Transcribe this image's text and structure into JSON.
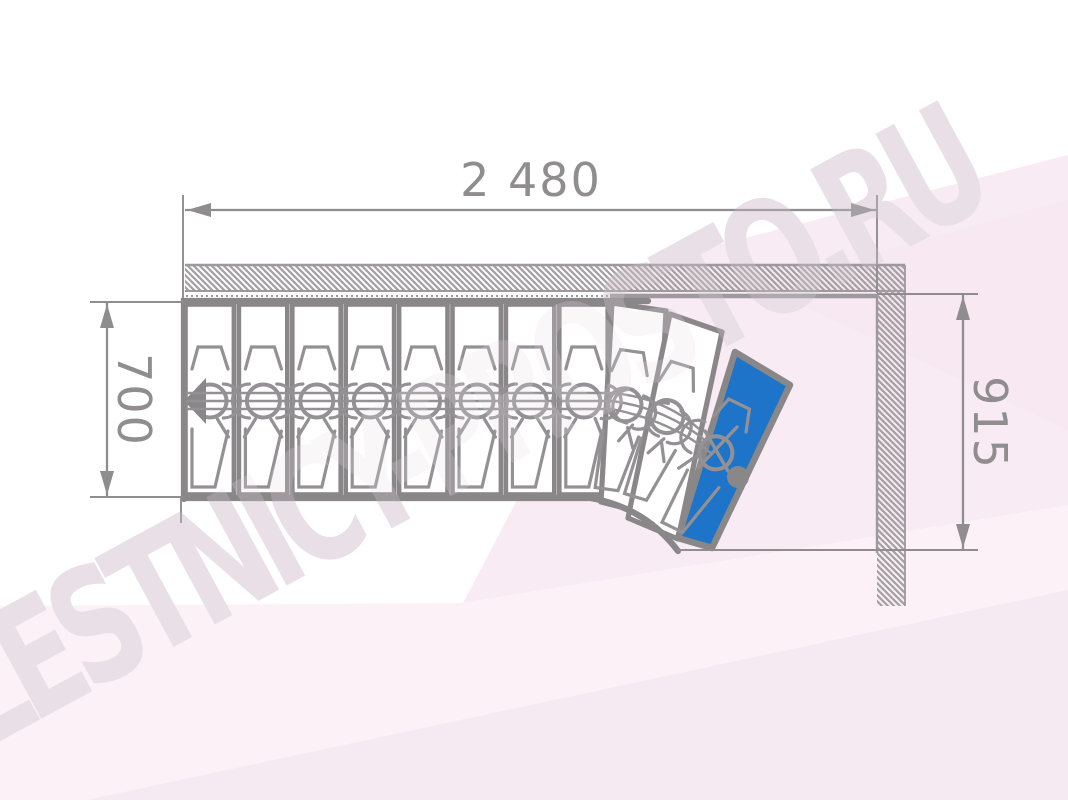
{
  "drawing": {
    "type": "staircase-floor-plan",
    "watermark_text": "LESTNICY-PROSTO.RU",
    "dimensions": {
      "total_run_label": "2 480",
      "stair_width_label": "700",
      "exit_offset_label": "915"
    },
    "steps": {
      "total": 11,
      "straight": 8,
      "winders": 3,
      "highlighted": "last step (turned, blue)"
    }
  },
  "colors": {
    "line": "#8a8789",
    "inner": "#949194",
    "dim": "#908d8f",
    "hatch": "#a5a1a4",
    "blue": "#1e74c8",
    "wm": "#e9dfe7",
    "bg1": "#f8ebf4",
    "bg2": "#fbf1f7",
    "bg3": "#f3e4ee"
  }
}
